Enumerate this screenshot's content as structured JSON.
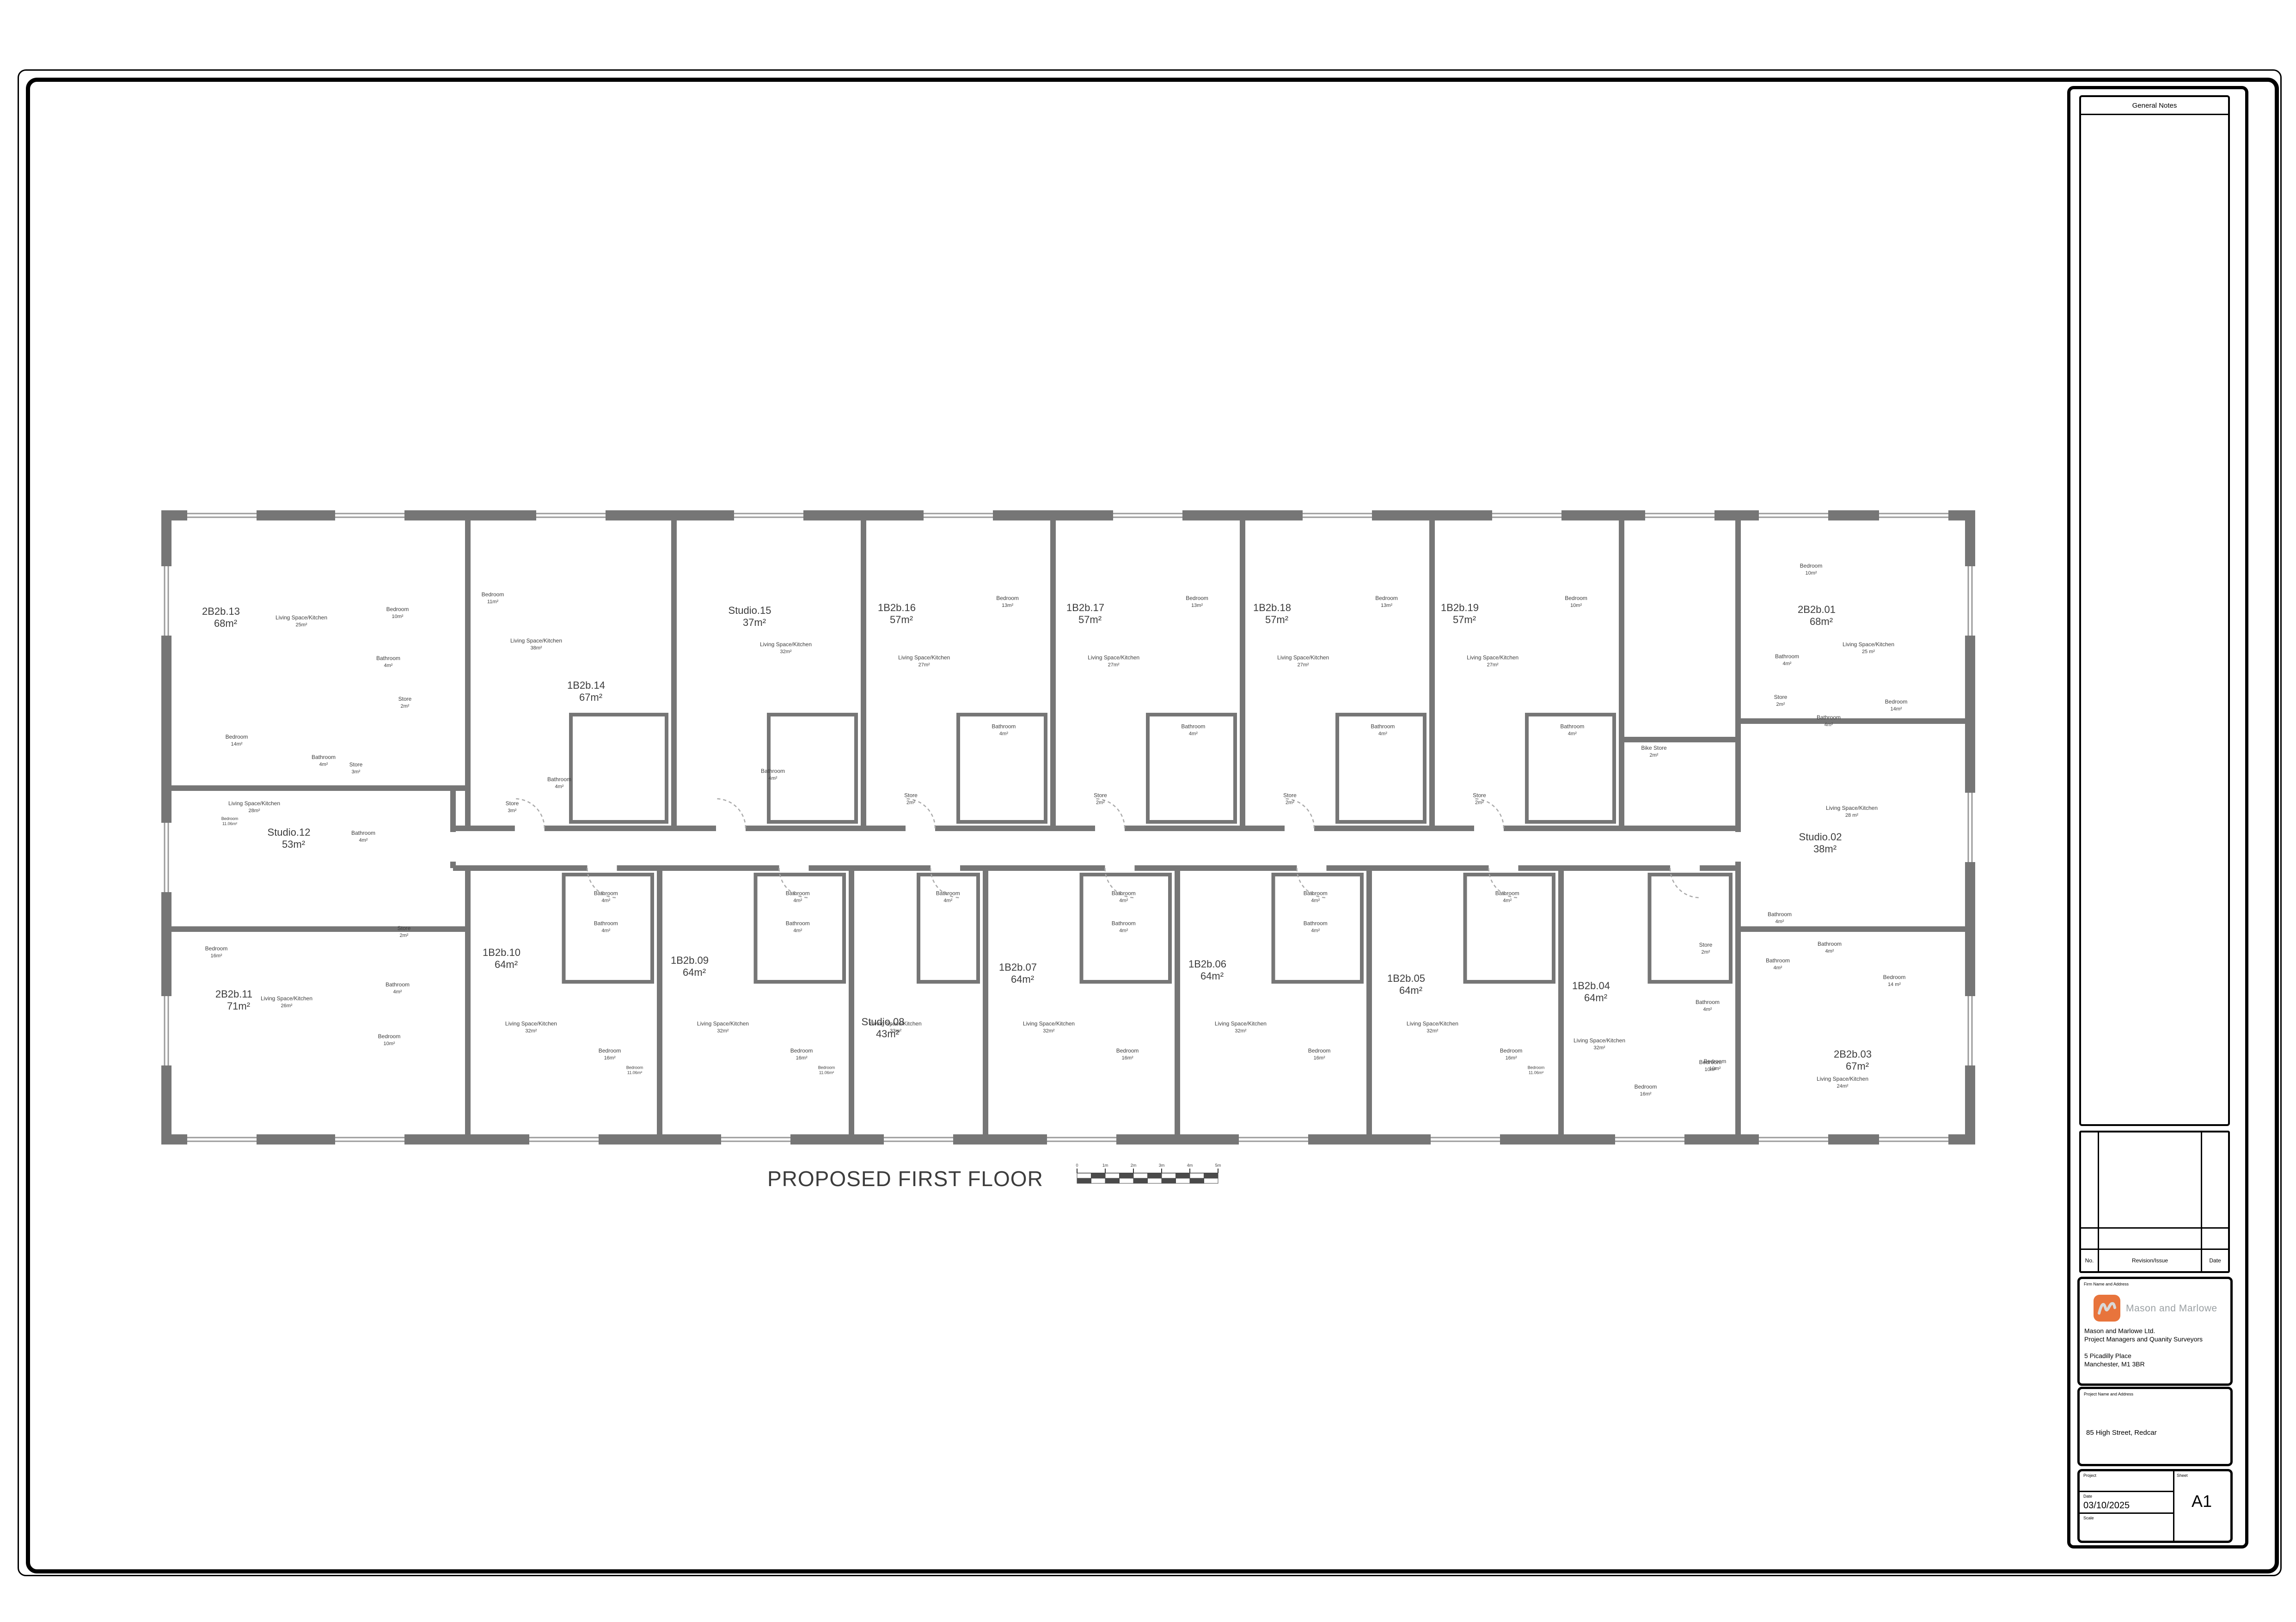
{
  "sheet": {
    "title": "PROPOSED FIRST FLOOR",
    "scale_bar": {
      "labels": [
        "0",
        "1m",
        "2m",
        "3m",
        "4m",
        "5m"
      ]
    },
    "general_notes": {
      "title": "General Notes"
    },
    "revision_table": {
      "no_label": "No.",
      "revision_label": "Revision/Issue",
      "date_label": "Date"
    },
    "firm_block": {
      "section_label": "Firm Name and Address",
      "brand_name": "Mason and Marlowe",
      "company_name": "Mason and Marlowe Ltd.",
      "company_role": "Project Managers and Quanity Surveyors",
      "address_line1": "5 Picadilly Place",
      "address_line2": "Manchester,  M1 3BR",
      "logo_color": "#e8743c"
    },
    "project_block": {
      "section_label": "Project Name and Address",
      "project_name": "85 High Street, Redcar"
    },
    "info_block": {
      "project_label": "Project",
      "date_label": "Date",
      "date_value": "03/10/2025",
      "scale_label": "Scale",
      "sheet_label": "Sheet",
      "sheet_value": "A1"
    }
  },
  "plan": {
    "wall_color": "#767676",
    "units": [
      {
        "id": "2B2b.01",
        "area": "68m²",
        "rooms": [
          {
            "name": "Living Space/Kitchen",
            "area": "25 m²"
          },
          {
            "name": "Bedroom",
            "area": "10m²"
          },
          {
            "name": "Bedroom",
            "area": "14m²"
          },
          {
            "name": "Bathroom",
            "area": "4m²"
          },
          {
            "name": "Bathroom",
            "area": "4m²"
          },
          {
            "name": "Store",
            "area": "2m²"
          }
        ]
      },
      {
        "id": "Studio.02",
        "area": "38m²",
        "rooms": [
          {
            "name": "Living Space/Kitchen",
            "area": "28 m²"
          },
          {
            "name": "Bathroom",
            "area": "4m²"
          }
        ]
      },
      {
        "id": "2B2b.03",
        "area": "67m²",
        "rooms": [
          {
            "name": "Living Space/Kitchen",
            "area": "24m²"
          },
          {
            "name": "Bedroom",
            "area": "14 m²"
          },
          {
            "name": "Bedroom",
            "area": "10m²"
          },
          {
            "name": "Bathroom",
            "area": "4m²"
          },
          {
            "name": "Bathroom",
            "area": "4m²"
          }
        ]
      },
      {
        "id": "1B2b.04",
        "area": "64m²",
        "rooms": [
          {
            "name": "Living Space/Kitchen",
            "area": "32m²"
          },
          {
            "name": "Bedroom",
            "area": "16m²"
          },
          {
            "name": "Bedroom",
            "area": "10m²"
          },
          {
            "name": "Bathroom",
            "area": "4m²"
          },
          {
            "name": "Store",
            "area": "2m²"
          }
        ]
      },
      {
        "id": "1B2b.05",
        "area": "64m²",
        "rooms": [
          {
            "name": "Living Space/Kitchen",
            "area": "32m²"
          },
          {
            "name": "Bedroom",
            "area": "16m²"
          },
          {
            "name": "Bedroom",
            "area": "11.06m²"
          },
          {
            "name": "Bathroom",
            "area": "4m²"
          }
        ]
      },
      {
        "id": "1B2b.06",
        "area": "64m²",
        "rooms": [
          {
            "name": "Living Space/Kitchen",
            "area": "32m²"
          },
          {
            "name": "Bedroom",
            "area": "16m²"
          },
          {
            "name": "Bathroom",
            "area": "4m²"
          },
          {
            "name": "Bathroom",
            "area": "4m²"
          }
        ]
      },
      {
        "id": "1B2b.07",
        "area": "64m²",
        "rooms": [
          {
            "name": "Living Space/Kitchen",
            "area": "32m²"
          },
          {
            "name": "Bedroom",
            "area": "16m²"
          },
          {
            "name": "Bathroom",
            "area": "4m²"
          },
          {
            "name": "Bathroom",
            "area": "4m²"
          }
        ]
      },
      {
        "id": "Studio.08",
        "area": "43m²",
        "rooms": [
          {
            "name": "Living Space/Kitchen",
            "area": "33m²"
          },
          {
            "name": "Bathroom",
            "area": "4m²"
          }
        ]
      },
      {
        "id": "1B2b.09",
        "area": "64m²",
        "rooms": [
          {
            "name": "Living Space/Kitchen",
            "area": "32m²"
          },
          {
            "name": "Bedroom",
            "area": "16m²"
          },
          {
            "name": "Bedroom",
            "area": "11.06m²"
          },
          {
            "name": "Bathroom",
            "area": "4m²"
          },
          {
            "name": "Bathroom",
            "area": "4m²"
          }
        ]
      },
      {
        "id": "1B2b.10",
        "area": "64m²",
        "rooms": [
          {
            "name": "Living Space/Kitchen",
            "area": "32m²"
          },
          {
            "name": "Bedroom",
            "area": "16m²"
          },
          {
            "name": "Bedroom",
            "area": "11.06m²"
          },
          {
            "name": "Bathroom",
            "area": "4m²"
          },
          {
            "name": "Bathroom",
            "area": "4m²"
          }
        ]
      },
      {
        "id": "2B2b.11",
        "area": "71m²",
        "rooms": [
          {
            "name": "Living Space/Kitchen",
            "area": "26m²"
          },
          {
            "name": "Bedroom",
            "area": "16m²"
          },
          {
            "name": "Bedroom",
            "area": "10m²"
          },
          {
            "name": "Bathroom",
            "area": "4m²"
          },
          {
            "name": "Store",
            "area": "2m²"
          }
        ]
      },
      {
        "id": "Studio.12",
        "area": "53m²",
        "rooms": [
          {
            "name": "Living Space/Kitchen",
            "area": "28m²"
          },
          {
            "name": "Bedroom",
            "area": "11.06m²"
          },
          {
            "name": "Bathroom",
            "area": "4m²"
          }
        ]
      },
      {
        "id": "2B2b.13",
        "area": "68m²",
        "rooms": [
          {
            "name": "Living Space/Kitchen",
            "area": "25m²"
          },
          {
            "name": "Bedroom",
            "area": "10m²"
          },
          {
            "name": "Bedroom",
            "area": "14m²"
          },
          {
            "name": "Bathroom",
            "area": "4m²"
          },
          {
            "name": "Bathroom",
            "area": "4m²"
          },
          {
            "name": "Store",
            "area": "2m²"
          }
        ]
      },
      {
        "id": "1B2b.14",
        "area": "67m²",
        "rooms": [
          {
            "name": "Living Space/Kitchen",
            "area": "38m²"
          },
          {
            "name": "Bedroom",
            "area": "11m²"
          },
          {
            "name": "Bathroom",
            "area": "4m²"
          },
          {
            "name": "Store",
            "area": "3m²"
          }
        ]
      },
      {
        "id": "Studio.15",
        "area": "37m²",
        "rooms": [
          {
            "name": "Living Space/Kitchen",
            "area": "32m²"
          },
          {
            "name": "Bathroom",
            "area": "4m²"
          }
        ]
      },
      {
        "id": "1B2b.16",
        "area": "57m²",
        "rooms": [
          {
            "name": "Living Space/Kitchen",
            "area": "27m²"
          },
          {
            "name": "Bedroom",
            "area": "13m²"
          },
          {
            "name": "Bathroom",
            "area": "4m²"
          },
          {
            "name": "Store",
            "area": "2m²"
          }
        ]
      },
      {
        "id": "1B2b.17",
        "area": "57m²",
        "rooms": [
          {
            "name": "Living Space/Kitchen",
            "area": "27m²"
          },
          {
            "name": "Bedroom",
            "area": "13m²"
          },
          {
            "name": "Bathroom",
            "area": "4m²"
          },
          {
            "name": "Store",
            "area": "2m²"
          }
        ]
      },
      {
        "id": "1B2b.18",
        "area": "57m²",
        "rooms": [
          {
            "name": "Living Space/Kitchen",
            "area": "27m²"
          },
          {
            "name": "Bedroom",
            "area": "13m²"
          },
          {
            "name": "Bathroom",
            "area": "4m²"
          },
          {
            "name": "Store",
            "area": "2m²"
          }
        ]
      },
      {
        "id": "1B2b.19",
        "area": "57m²",
        "rooms": [
          {
            "name": "Living Space/Kitchen",
            "area": "27m²"
          },
          {
            "name": "Bedroom",
            "area": "10m²"
          },
          {
            "name": "Bathroom",
            "area": "4m²"
          },
          {
            "name": "Store",
            "area": "2m²"
          }
        ]
      }
    ],
    "communal_labels": [
      {
        "name": "Bike Store",
        "area": "2m²"
      },
      {
        "name": "Store",
        "area": "3m²"
      }
    ]
  }
}
